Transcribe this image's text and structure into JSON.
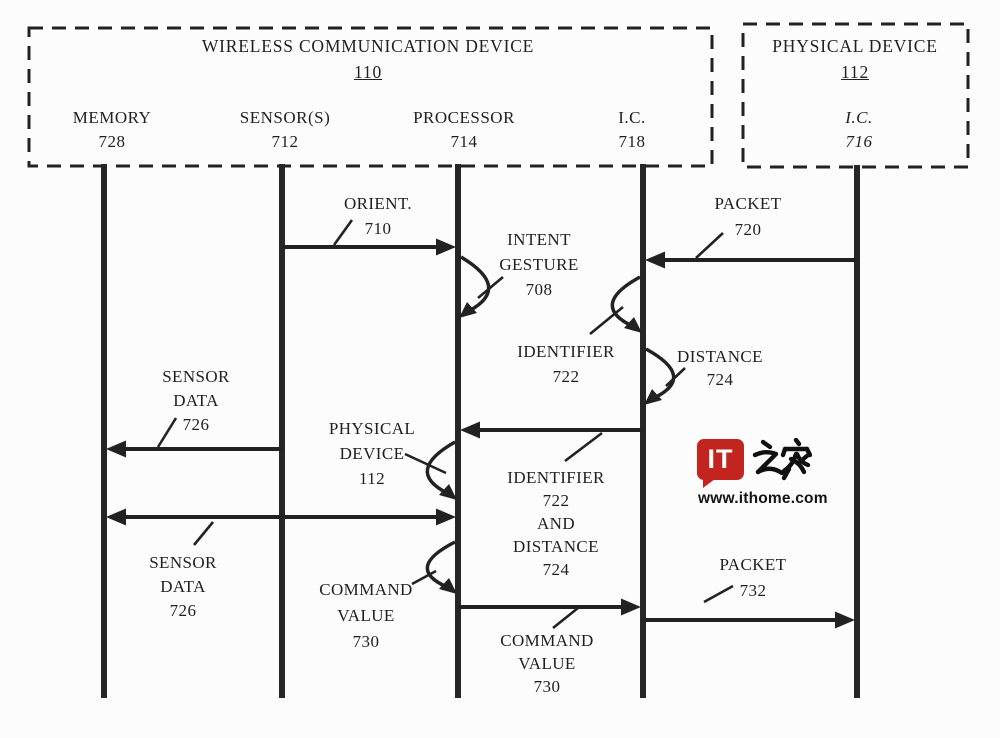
{
  "figure": {
    "boxes": [
      {
        "id": "wireless-communication-device",
        "title": "WIRELESS COMMUNICATION DEVICE",
        "ref": "110",
        "x": 29,
        "y": 28,
        "w": 683,
        "h": 138,
        "title_cx": 368,
        "title_top": 33
      },
      {
        "id": "physical-device",
        "title": "PHYSICAL DEVICE",
        "ref": "112",
        "x": 743,
        "y": 24,
        "w": 225,
        "h": 143,
        "title_cx": 855,
        "title_top": 33
      }
    ],
    "lifelines": [
      {
        "name": "memory",
        "label": "MEMORY",
        "ref": "728",
        "x": 104,
        "top": 164,
        "bottom": 698,
        "label_x": 112,
        "italic": false
      },
      {
        "name": "sensors",
        "label": "SENSOR(S)",
        "ref": "712",
        "x": 282,
        "top": 164,
        "bottom": 698,
        "label_x": 285,
        "italic": false
      },
      {
        "name": "processor",
        "label": "PROCESSOR",
        "ref": "714",
        "x": 458,
        "top": 164,
        "bottom": 698,
        "label_x": 464,
        "italic": false
      },
      {
        "name": "ic-718",
        "label": "I.C.",
        "ref": "718",
        "x": 643,
        "top": 164,
        "bottom": 698,
        "label_x": 632,
        "italic": false
      },
      {
        "name": "ic-716",
        "label": "I.C.",
        "ref": "716",
        "x": 857,
        "top": 165,
        "bottom": 698,
        "label_x": 859,
        "italic": true
      }
    ],
    "header_name_top": 106,
    "header_ref_top": 130,
    "arrows": [
      {
        "name": "arrow-orient-710",
        "y": 247,
        "x1": 282,
        "x2": 458,
        "heads": "right"
      },
      {
        "name": "arrow-packet-720",
        "y": 260,
        "x1": 643,
        "x2": 857,
        "heads": "left"
      },
      {
        "name": "arrow-identifier-and-distance",
        "y": 430,
        "x1": 458,
        "x2": 643,
        "heads": "left"
      },
      {
        "name": "arrow-sensor-data-726",
        "y": 449,
        "x1": 104,
        "x2": 282,
        "heads": "left"
      },
      {
        "name": "arrow-memory-processor",
        "y": 517,
        "x1": 104,
        "x2": 458,
        "heads": "both"
      },
      {
        "name": "arrow-command-value-730",
        "y": 607,
        "x1": 458,
        "x2": 643,
        "heads": "right"
      },
      {
        "name": "arrow-packet-732",
        "y": 620,
        "x1": 643,
        "x2": 857,
        "heads": "right"
      }
    ],
    "self_loops": [
      {
        "name": "loop-intent-gesture-708",
        "x": 458,
        "side": "right",
        "y1": 257,
        "y2": 318
      },
      {
        "name": "loop-identifier-722",
        "x": 643,
        "side": "left",
        "y1": 277,
        "y2": 333
      },
      {
        "name": "loop-distance-724",
        "x": 643,
        "side": "right",
        "y1": 349,
        "y2": 405
      },
      {
        "name": "loop-physical-device-112",
        "x": 458,
        "side": "left",
        "y1": 442,
        "y2": 500
      },
      {
        "name": "loop-command-value-730",
        "x": 458,
        "side": "left",
        "y1": 542,
        "y2": 594
      }
    ],
    "labels": [
      {
        "name": "label-orient-710",
        "lines": [
          "ORIENT.",
          "710"
        ],
        "cx": 378,
        "top": 191,
        "lh": 25
      },
      {
        "name": "label-intent-gesture-708",
        "lines": [
          "INTENT",
          "GESTURE",
          "708"
        ],
        "cx": 539,
        "top": 227,
        "lh": 25
      },
      {
        "name": "label-packet-720",
        "lines": [
          "PACKET",
          "720"
        ],
        "cx": 748,
        "top": 191,
        "lh": 26
      },
      {
        "name": "label-identifier-722",
        "lines": [
          "IDENTIFIER",
          "722"
        ],
        "cx": 566,
        "top": 339,
        "lh": 25
      },
      {
        "name": "label-distance-724",
        "lines": [
          "DISTANCE",
          "724"
        ],
        "cx": 720,
        "top": 345,
        "lh": 23
      },
      {
        "name": "label-sensor-data-726-upper",
        "lines": [
          "SENSOR",
          "DATA",
          "726"
        ],
        "cx": 196,
        "top": 365,
        "lh": 24
      },
      {
        "name": "label-physical-device-112",
        "lines": [
          "PHYSICAL",
          "DEVICE",
          "112"
        ],
        "cx": 372,
        "top": 416,
        "lh": 25
      },
      {
        "name": "label-identifier-722-and-distance-724",
        "lines": [
          "IDENTIFIER",
          "722",
          "AND",
          "DISTANCE",
          "724"
        ],
        "cx": 556,
        "top": 466,
        "lh": 23
      },
      {
        "name": "label-sensor-data-726-lower",
        "lines": [
          "SENSOR",
          "DATA",
          "726"
        ],
        "cx": 183,
        "top": 551,
        "lh": 24
      },
      {
        "name": "label-command-value-730-left",
        "lines": [
          "COMMAND",
          "VALUE",
          "730"
        ],
        "cx": 366,
        "top": 577,
        "lh": 26
      },
      {
        "name": "label-command-value-730-right",
        "lines": [
          "COMMAND",
          "VALUE",
          "730"
        ],
        "cx": 547,
        "top": 629,
        "lh": 23
      },
      {
        "name": "label-packet-732",
        "lines": [
          "PACKET",
          "732"
        ],
        "cx": 753,
        "top": 552,
        "lh": 26
      }
    ],
    "leads": [
      {
        "name": "lead-orient-710",
        "x1": 352,
        "y1": 220,
        "x2": 334,
        "y2": 245
      },
      {
        "name": "lead-intent-gesture-708",
        "x1": 503,
        "y1": 277,
        "x2": 478,
        "y2": 298
      },
      {
        "name": "lead-packet-720",
        "x1": 723,
        "y1": 233,
        "x2": 696,
        "y2": 258
      },
      {
        "name": "lead-identifier-722",
        "x1": 623,
        "y1": 307,
        "x2": 590,
        "y2": 334
      },
      {
        "name": "lead-distance-724",
        "x1": 685,
        "y1": 368,
        "x2": 666,
        "y2": 386
      },
      {
        "name": "lead-sensor-data-726-upper",
        "x1": 176,
        "y1": 418,
        "x2": 158,
        "y2": 447
      },
      {
        "name": "lead-physical-device-112",
        "x1": 405,
        "y1": 454,
        "x2": 446,
        "y2": 473
      },
      {
        "name": "lead-identifier-and-distance",
        "x1": 565,
        "y1": 461,
        "x2": 602,
        "y2": 433
      },
      {
        "name": "lead-sensor-data-726-lower",
        "x1": 213,
        "y1": 522,
        "x2": 194,
        "y2": 545
      },
      {
        "name": "lead-command-value-730-left",
        "x1": 412,
        "y1": 584,
        "x2": 436,
        "y2": 571
      },
      {
        "name": "lead-command-value-730-right",
        "x1": 553,
        "y1": 628,
        "x2": 578,
        "y2": 608
      },
      {
        "name": "lead-packet-732",
        "x1": 733,
        "y1": 586,
        "x2": 704,
        "y2": 602
      }
    ]
  },
  "watermark": {
    "logo_text": "IT",
    "logo_chars": "之家",
    "url": "www.ithome.com",
    "red": "#c22420"
  },
  "colors": {
    "ink": "#1e1e1e",
    "line": "#222222",
    "background": "#fcfcfc"
  }
}
